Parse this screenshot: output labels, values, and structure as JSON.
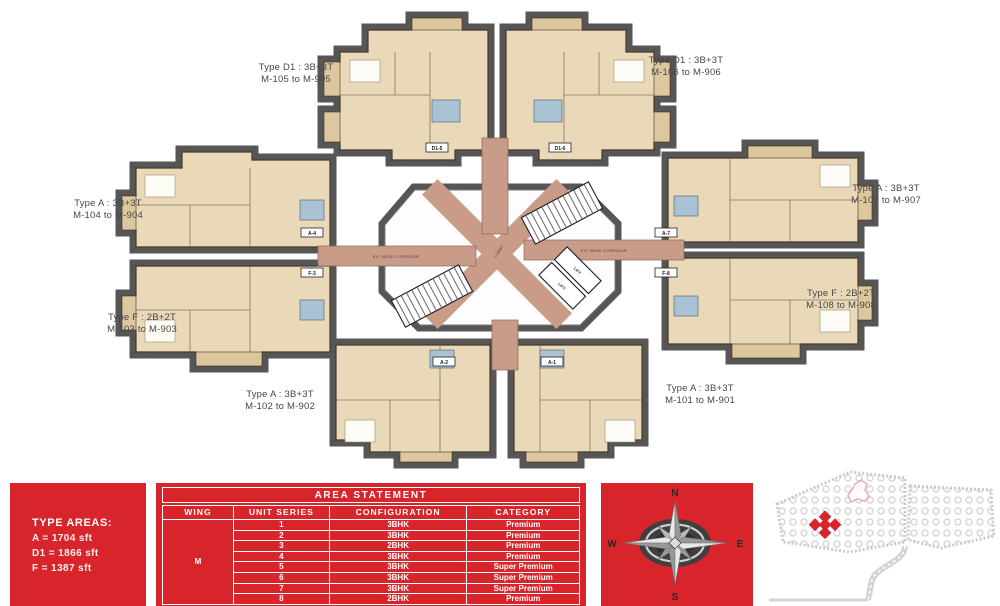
{
  "colors": {
    "brand_red": "#d8242b",
    "corridor_salmon": "#c99c8a",
    "unit_beige": "#ead9b9",
    "shadow_gray": "#565656"
  },
  "plan": {
    "corridor_label": "6'6\" WIDE CORRIDOR",
    "lobby_label": "LOBBY",
    "lift_label": "LIFT",
    "unit_tags": {
      "d1_5": "D1-5",
      "d1_6": "D1-6",
      "a_4": "A-4",
      "a_7": "A-7",
      "f_3": "F-3",
      "f_8": "F-8",
      "a_2": "A-2",
      "a_1": "A-1"
    },
    "labels": [
      {
        "line1": "Type D1 : 3B+3T",
        "line2": "M-105 to M-905"
      },
      {
        "line1": "Type D1 : 3B+3T",
        "line2": "M-106 to M-906"
      },
      {
        "line1": "Type A : 3B+3T",
        "line2": "M-104 to M-904"
      },
      {
        "line1": "Type A : 3B+3T",
        "line2": "M-107 to M-907"
      },
      {
        "line1": "Type F : 2B+2T",
        "line2": "M-103 to M-903"
      },
      {
        "line1": "Type F : 2B+2T",
        "line2": "M-108 to M-908"
      },
      {
        "line1": "Type A : 3B+3T",
        "line2": "M-102 to M-902"
      },
      {
        "line1": "Type A : 3B+3T",
        "line2": "M-101 to M-901"
      }
    ]
  },
  "type_areas": {
    "title": "TYPE AREAS:",
    "lines": [
      "A = 1704 sft",
      "D1 = 1866 sft",
      "F = 1387 sft"
    ]
  },
  "area_statement": {
    "title": "AREA STATEMENT",
    "columns": [
      "WING",
      "UNIT SERIES",
      "CONFIGURATION",
      "CATEGORY"
    ],
    "wing": "M",
    "rows": [
      {
        "unit_series": "1",
        "configuration": "3BHK",
        "category": "Premium"
      },
      {
        "unit_series": "2",
        "configuration": "3BHK",
        "category": "Premium"
      },
      {
        "unit_series": "3",
        "configuration": "2BHK",
        "category": "Premium"
      },
      {
        "unit_series": "4",
        "configuration": "3BHK",
        "category": "Premium"
      },
      {
        "unit_series": "5",
        "configuration": "3BHK",
        "category": "Super Premium"
      },
      {
        "unit_series": "6",
        "configuration": "3BHK",
        "category": "Super Premium"
      },
      {
        "unit_series": "7",
        "configuration": "3BHK",
        "category": "Super Premium"
      },
      {
        "unit_series": "8",
        "configuration": "2BHK",
        "category": "Premium"
      }
    ]
  },
  "compass": {
    "n": "N",
    "s": "S",
    "e": "E",
    "w": "W"
  }
}
